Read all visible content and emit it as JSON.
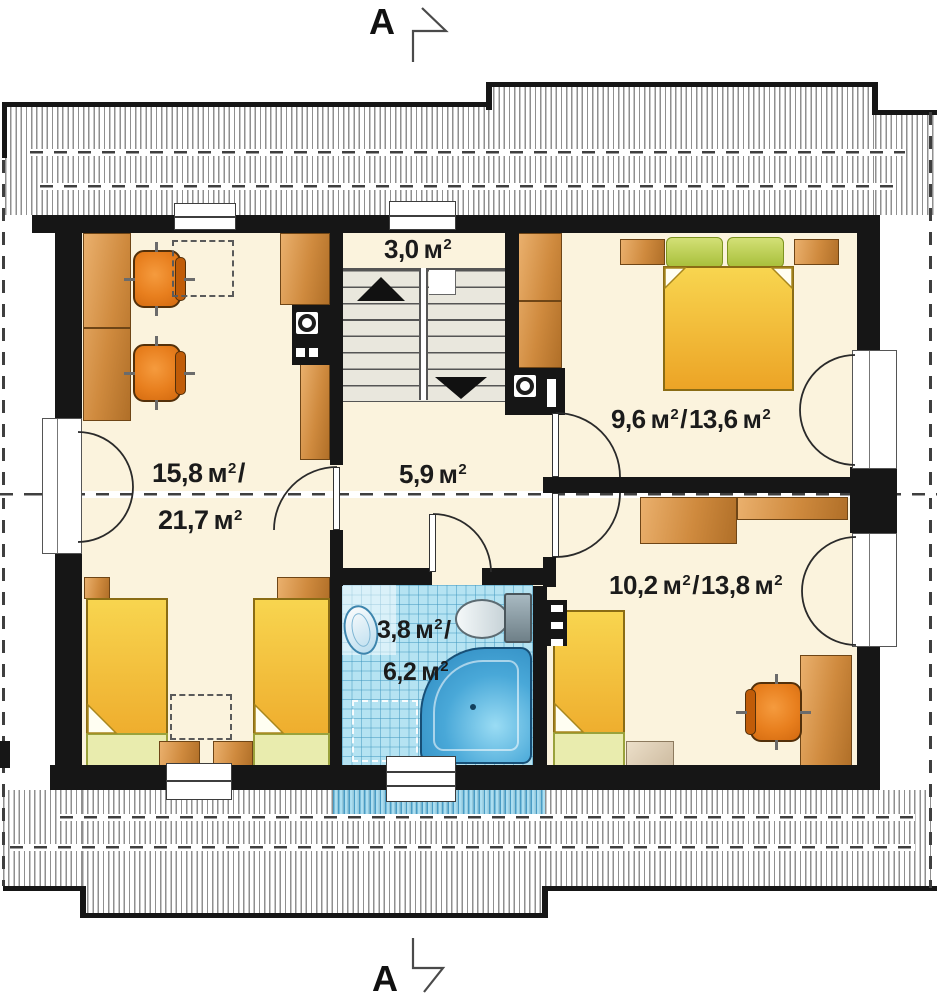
{
  "title": "Attic floor plan",
  "section_markers": {
    "top": "A",
    "bottom": "A"
  },
  "areas": {
    "stairwell": {
      "value": "3,0",
      "unit": "м",
      "sup": "2"
    },
    "hall": {
      "value": "5,9",
      "unit": "м",
      "sup": "2"
    },
    "living_room": {
      "value1": "15,8",
      "value2": "21,7",
      "unit": "м",
      "sup": "2",
      "slash": "/"
    },
    "bedroom_top": {
      "value1": "9,6",
      "value2": "13,6",
      "unit": "м",
      "sup": "2",
      "slash": "/"
    },
    "bedroom_bottom": {
      "value1": "10,2",
      "value2": "13,8",
      "unit": "м",
      "sup": "2",
      "slash": "/"
    },
    "bathroom": {
      "value1": "3,8",
      "value2": "6,2",
      "unit": "м",
      "sup": "2",
      "slash": "/"
    }
  },
  "colors": {
    "wall": "#161616",
    "floor": "#fbf3dd",
    "stair": "#e9e7dd",
    "tile": "#b5e3f2",
    "chair": "#e87f1e",
    "text": "#1b1b1b",
    "dash": "#3f3f3f",
    "hatch": "#8f8f8f"
  }
}
